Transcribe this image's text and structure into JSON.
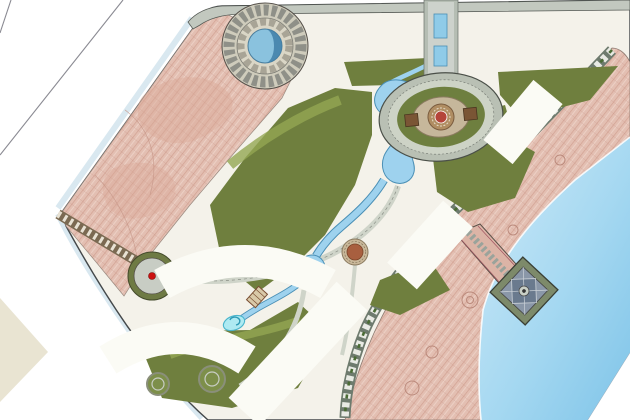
{
  "plan": {
    "type": "residential-waterfront-master-plan",
    "floor_labels": [
      {
        "text": "1#",
        "x": 336,
        "y": 44,
        "rot": 0
      },
      {
        "text": "26F",
        "x": 410,
        "y": 48,
        "rot": 0
      },
      {
        "text": "4#",
        "x": 462,
        "y": 41,
        "rot": 0
      },
      {
        "text": "28.5F",
        "x": 494,
        "y": 41,
        "rot": 0
      },
      {
        "text": "2F",
        "x": 457,
        "y": 64,
        "rot": 0
      },
      {
        "text": "2F",
        "x": 506,
        "y": 63,
        "rot": 0
      },
      {
        "text": "1F",
        "x": 554,
        "y": 62,
        "rot": 0
      },
      {
        "text": "2F",
        "x": 610,
        "y": 53,
        "rot": 0
      },
      {
        "text": "1F",
        "x": 561,
        "y": 88,
        "rot": 0
      },
      {
        "text": "28.5F",
        "x": 531,
        "y": 125,
        "rot": 0
      },
      {
        "text": "1F",
        "x": 514,
        "y": 153,
        "rot": 0
      },
      {
        "text": "6#",
        "x": 450,
        "y": 177,
        "rot": 0
      },
      {
        "text": "28.5F",
        "x": 481,
        "y": 181,
        "rot": 0
      },
      {
        "text": "1F",
        "x": 440,
        "y": 243,
        "rot": 0
      },
      {
        "text": "28.5F",
        "x": 406,
        "y": 257,
        "rot": 0
      },
      {
        "text": "2F",
        "x": 377,
        "y": 294,
        "rot": 0
      },
      {
        "text": "28.5F",
        "x": 337,
        "y": 318,
        "rot": 0
      },
      {
        "text": "1F",
        "x": 306,
        "y": 352,
        "rot": 0
      },
      {
        "text": "28.5F",
        "x": 274,
        "y": 367,
        "rot": 0
      },
      {
        "text": "2F",
        "x": 305,
        "y": 90,
        "rot": -50
      },
      {
        "text": "2F",
        "x": 204,
        "y": 198,
        "rot": -50
      },
      {
        "text": "1#",
        "x": 192,
        "y": 219,
        "rot": -50
      },
      {
        "text": "1#",
        "x": 110,
        "y": 322,
        "rot": 0
      },
      {
        "text": "1F",
        "x": 228,
        "y": 404,
        "rot": 0
      }
    ],
    "gate_labels": [
      {
        "text": "2F",
        "x": 167,
        "y": 247
      },
      {
        "text": "2F",
        "x": 128,
        "y": 297
      }
    ],
    "beach_label": {
      "text": "沙滩",
      "x": 508,
      "y": 190,
      "rot": -48
    },
    "markers": [
      {
        "n": "1",
        "x": 440,
        "y": 13
      },
      {
        "n": "2",
        "x": 440,
        "y": 29
      },
      {
        "n": "3",
        "x": 440,
        "y": 63
      },
      {
        "n": "7",
        "x": 405,
        "y": 88
      },
      {
        "n": "9",
        "x": 388,
        "y": 95
      },
      {
        "n": "10",
        "x": 353,
        "y": 96
      },
      {
        "n": "4",
        "x": 441,
        "y": 99
      },
      {
        "n": "5",
        "x": 431,
        "y": 107
      },
      {
        "n": "",
        "x": 449,
        "y": 107
      },
      {
        "n": "6",
        "x": 441,
        "y": 122
      },
      {
        "n": "",
        "x": 495,
        "y": 104
      },
      {
        "n": "",
        "x": 542,
        "y": 93
      },
      {
        "n": "8",
        "x": 393,
        "y": 152
      },
      {
        "n": "",
        "x": 438,
        "y": 151
      },
      {
        "n": "11",
        "x": 417,
        "y": 164
      },
      {
        "n": "",
        "x": 397,
        "y": 167
      },
      {
        "n": "12",
        "x": 322,
        "y": 185
      },
      {
        "n": "13",
        "x": 290,
        "y": 192
      },
      {
        "n": "",
        "x": 275,
        "y": 187
      },
      {
        "n": "",
        "x": 260,
        "y": 202
      },
      {
        "n": "",
        "x": 322,
        "y": 216
      },
      {
        "n": "",
        "x": 325,
        "y": 244
      },
      {
        "n": "14",
        "x": 352,
        "y": 251
      },
      {
        "n": "",
        "x": 383,
        "y": 210
      },
      {
        "n": "",
        "x": 167,
        "y": 307
      },
      {
        "n": "",
        "x": 228,
        "y": 318
      },
      {
        "n": "",
        "x": 250,
        "y": 280
      },
      {
        "n": "",
        "x": 307,
        "y": 317
      },
      {
        "n": "",
        "x": 282,
        "y": 325
      },
      {
        "n": "",
        "x": 208,
        "y": 378
      },
      {
        "n": "",
        "x": 163,
        "y": 385
      },
      {
        "n": "",
        "x": 227,
        "y": 352
      },
      {
        "n": "",
        "x": 263,
        "y": 303
      }
    ],
    "colors": {
      "marker": "#df1212",
      "marker_ring": "#8d0d0d",
      "water_deep": "#7fc4e8",
      "water_light": "#d2ecf8",
      "lagoon": "#9ed2ee",
      "sand": "#e3bfb2",
      "sand_line": "#cf9d8e",
      "green_base": "#6f7f3e",
      "tree_dark": "#3c5a2a",
      "tree_yellow": "#d6ce58",
      "tree_mid": "#7fa04a",
      "building_fill": "#ffffff",
      "building_stroke": "#5a6065",
      "road": "#c2c8bf",
      "cream": "#e9e4d2"
    }
  }
}
